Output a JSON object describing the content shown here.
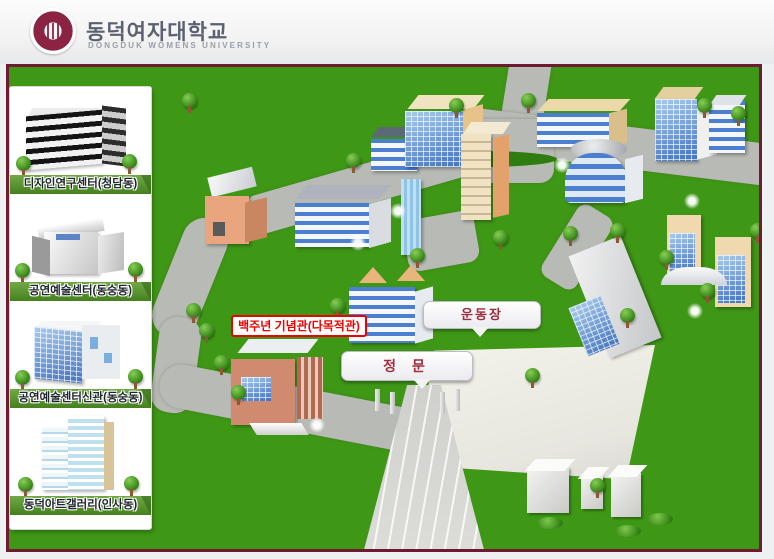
{
  "header": {
    "title_ko": "동덕여자대학교",
    "title_en": "DONGDUK WOMENS UNIVERSITY"
  },
  "sidebar": {
    "items": [
      {
        "label": "디자인연구센터(청담동)"
      },
      {
        "label": "공연예술센터(동숭동)"
      },
      {
        "label": "공연예술센터신관(동숭동)"
      },
      {
        "label": "동덕아트갤러리(인사동)"
      }
    ]
  },
  "map": {
    "labels": {
      "centennial_hall": "백주년 기념관(다목적관)",
      "playground": "운동장",
      "main_gate": "정 문"
    }
  },
  "colors": {
    "grass": "#3f9716",
    "road": "#b8bab5",
    "map_border": "#6e1b31",
    "seal_maroon": "#8b2342",
    "highlight_red": "#ee0000",
    "bubble_text": "#a12c3e"
  }
}
